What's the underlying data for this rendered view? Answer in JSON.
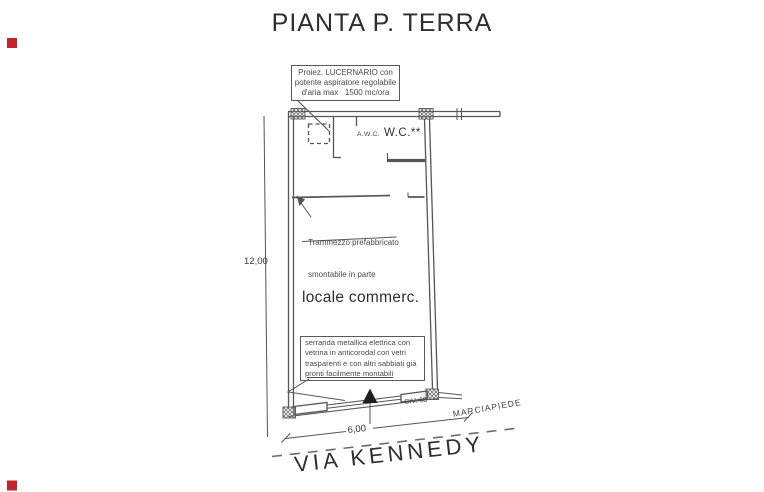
{
  "title": "PIANTA P. TERRA",
  "colors": {
    "marker_red": "#c4232b",
    "line": "#565656",
    "text": "#3c3c3c"
  },
  "plan": {
    "skylight_note": {
      "line1": "Proiez. LUCERNARIO con",
      "line2": "potente aspiratore regolabile",
      "line3": "d'aria max   1500 mc/ora"
    },
    "awc_label": "A.W.C.",
    "wc_label": "W.C.**",
    "partition_note": {
      "line1": "Trammezzo prefabbricato",
      "line2": "smontabile in parte"
    },
    "room_label": "locale commerc.",
    "shutter_note": {
      "line1": "serranda metallica elettrica con",
      "line2": "vetrina in anticorodal con vetri",
      "line3": "trasparenti e con altri sabbiati già",
      "line4": "pronti facilmente montabili"
    },
    "dimensions": {
      "height": "12,00",
      "width": "6,00"
    },
    "civic_number": "CIV. 68",
    "sidewalk_label": "MARCIAPIEDE",
    "street_label": "VIA KENNEDY"
  }
}
